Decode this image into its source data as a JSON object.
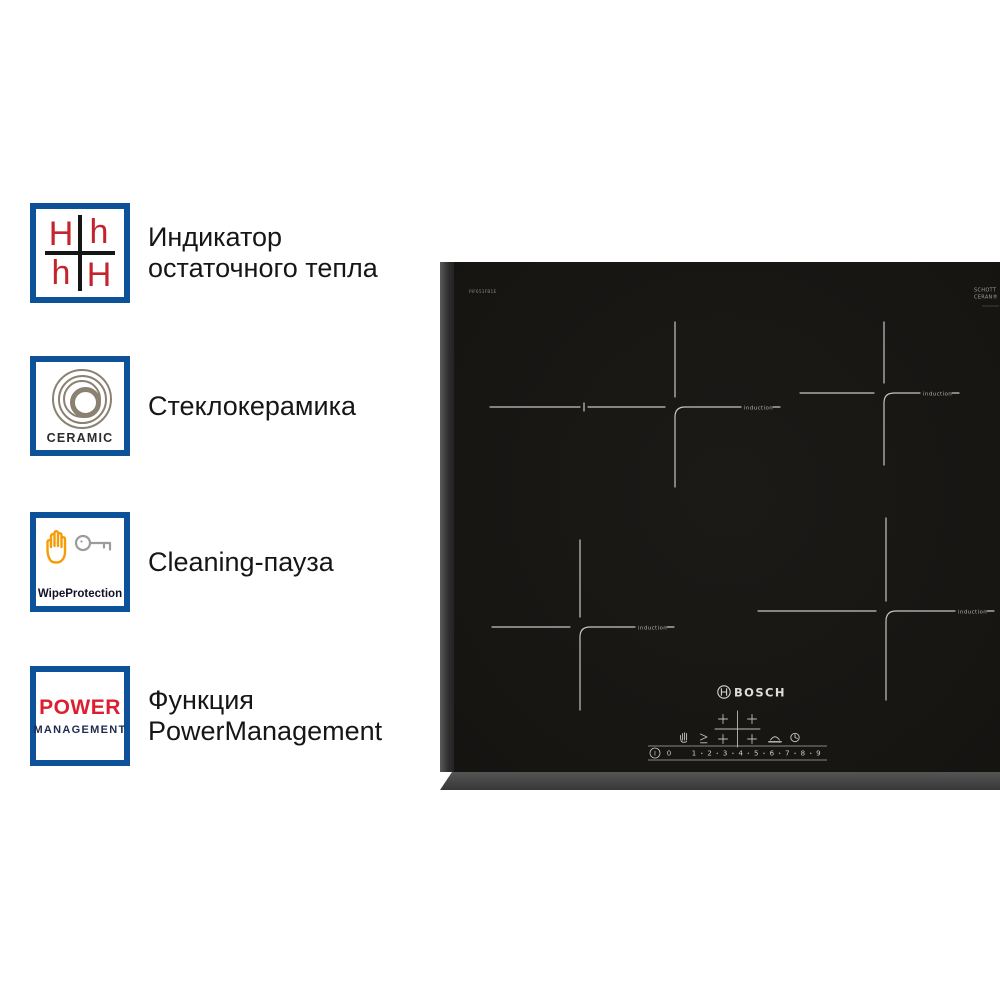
{
  "features": [
    {
      "title_lines": [
        "Индикатор",
        "остаточного тепла"
      ],
      "badge": {
        "kind": "residual-heat-indicator",
        "letters": [
          "H",
          "h",
          "h",
          "H"
        ]
      }
    },
    {
      "title_lines": [
        "Стеклокерамика"
      ],
      "badge": {
        "kind": "glass-ceramic",
        "caption": "CERAMIC"
      }
    },
    {
      "title_lines": [
        "Cleaning-пауза"
      ],
      "badge": {
        "kind": "wipe-protection",
        "caption": "WipeProtection"
      }
    },
    {
      "title_lines": [
        "Функция",
        "PowerManagement"
      ],
      "badge": {
        "kind": "power-management",
        "word1": "POWER",
        "word2": "MANAGEMENT"
      }
    }
  ],
  "cooktop": {
    "model_code": "PIF651FB1E",
    "glass_brand_line1": "SCHOTT",
    "glass_brand_line2": "CERAN®",
    "brand": "BOSCH",
    "zone_label": "induction",
    "control": {
      "power_symbol": "I",
      "levels": [
        "0",
        "1",
        "2",
        "3",
        "4",
        "5",
        "6",
        "7",
        "8",
        "9"
      ]
    }
  },
  "colors": {
    "badge_border_blue": "#0d5298",
    "badge_red": "#c4242e",
    "badge_navy": "#1f2b50",
    "ceramic_ring": "#8a8172",
    "hand_orange": "#f59c07",
    "key_gray": "#9b9b9b",
    "glass_black": "#191714",
    "zone_line": "#d6d5d0"
  }
}
